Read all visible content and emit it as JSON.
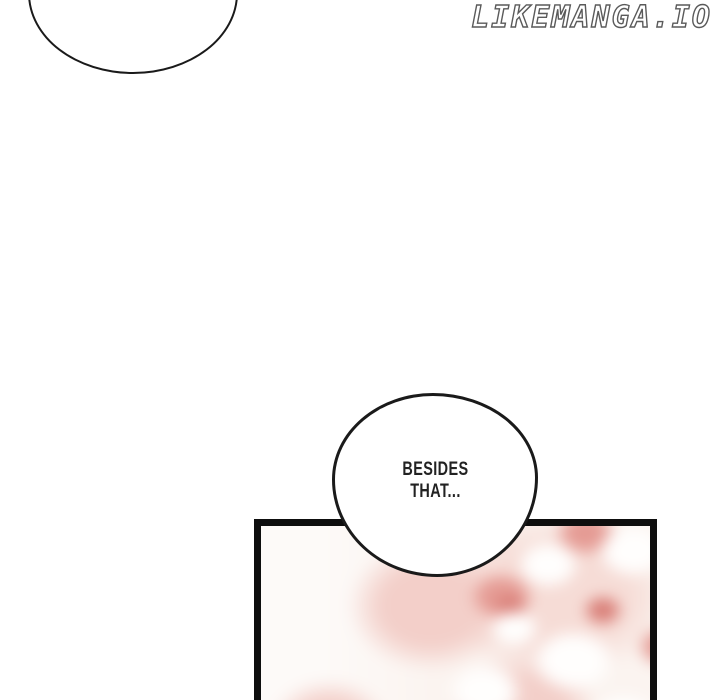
{
  "watermark": {
    "text": "LIKEMANGA.IO"
  },
  "speech": {
    "partial_bubble": {
      "text": ""
    },
    "center_bubble": {
      "line1": "BESIDES",
      "line2": "THAT..."
    }
  },
  "panel": {
    "description": "blurred pink blossom artwork"
  },
  "colors": {
    "ink": "#1a1a1a",
    "panel-border": "#0e0e0e",
    "watermark-outline": "#5a5a5a",
    "floral-base": "#fbf4f0",
    "floral-pink": "#f3cfc9",
    "floral-red": "#e59b94",
    "floral-deep-red": "#d97f78",
    "floral-white": "#fffefd"
  }
}
